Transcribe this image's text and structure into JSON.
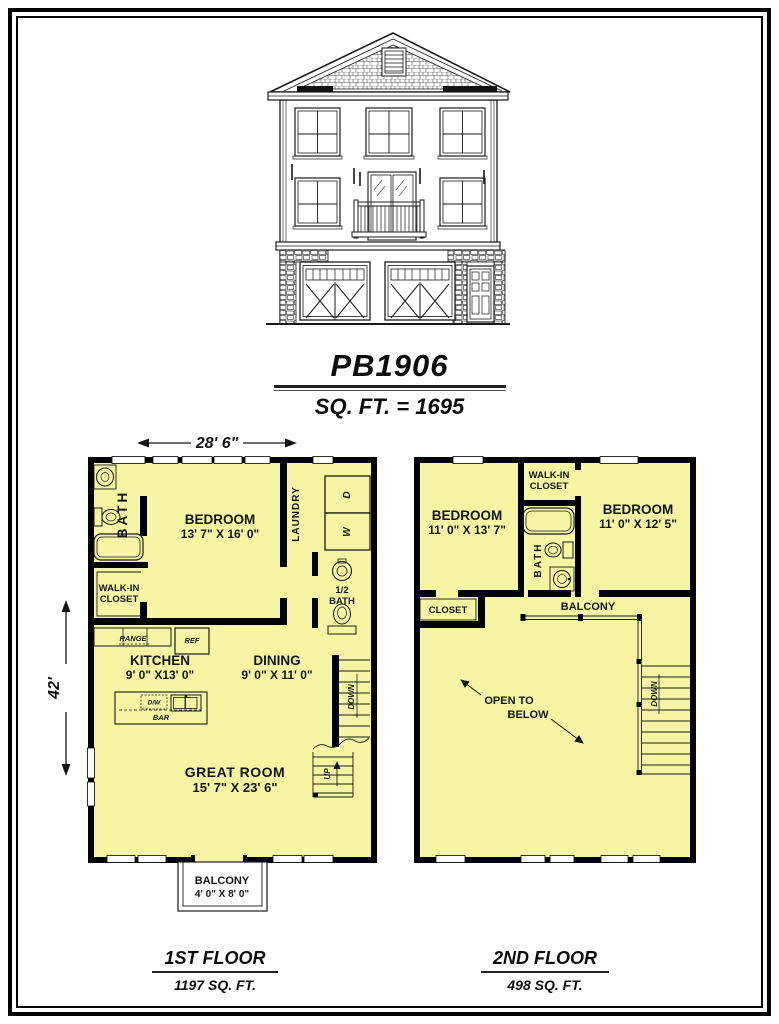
{
  "colors": {
    "floor_fill": "#f5f5a3",
    "wall": "#000000",
    "ink": "#151515"
  },
  "title": {
    "plan_number": "PB1906",
    "total_sqft": "SQ. FT. = 1695"
  },
  "dimensions": {
    "width": "28' 6\"",
    "depth": "42'"
  },
  "floor1": {
    "name": "1ST FLOOR",
    "sqft": "1197 SQ. FT.",
    "bath": "BATH",
    "bedroom": "BEDROOM",
    "bedroom_size": "13' 7\" X 16' 0\"",
    "laundry": "LAUNDRY",
    "dryer": "D",
    "washer": "W",
    "walkin_1": "WALK-IN",
    "walkin_2": "CLOSET",
    "half_bath_1": "1/2",
    "half_bath_2": "BATH",
    "range": "RANGE",
    "ref": "REF",
    "dw": "D/W",
    "bar": "BAR",
    "kitchen": "KITCHEN",
    "kitchen_size": "9' 0\" X13' 0\"",
    "dining": "DINING",
    "dining_size": "9' 0\" X 11' 0\"",
    "great_room": "GREAT ROOM",
    "great_room_size": "15' 7\" X 23' 6\"",
    "down": "DOWN",
    "up": "UP",
    "balcony": "BALCONY",
    "balcony_size": "4' 0\" X 8' 0\""
  },
  "floor2": {
    "name": "2ND FLOOR",
    "sqft": "498 SQ. FT.",
    "bedroom_left": "BEDROOM",
    "bedroom_left_size": "11' 0\" X 13' 7\"",
    "walkin_1": "WALK-IN",
    "walkin_2": "CLOSET",
    "bath": "BATH",
    "bedroom_right": "BEDROOM",
    "bedroom_right_size": "11' 0\" X 12' 5\"",
    "closet": "CLOSET",
    "balcony": "BALCONY",
    "open_1": "OPEN TO",
    "open_2": "BELOW",
    "down": "DOWN"
  }
}
